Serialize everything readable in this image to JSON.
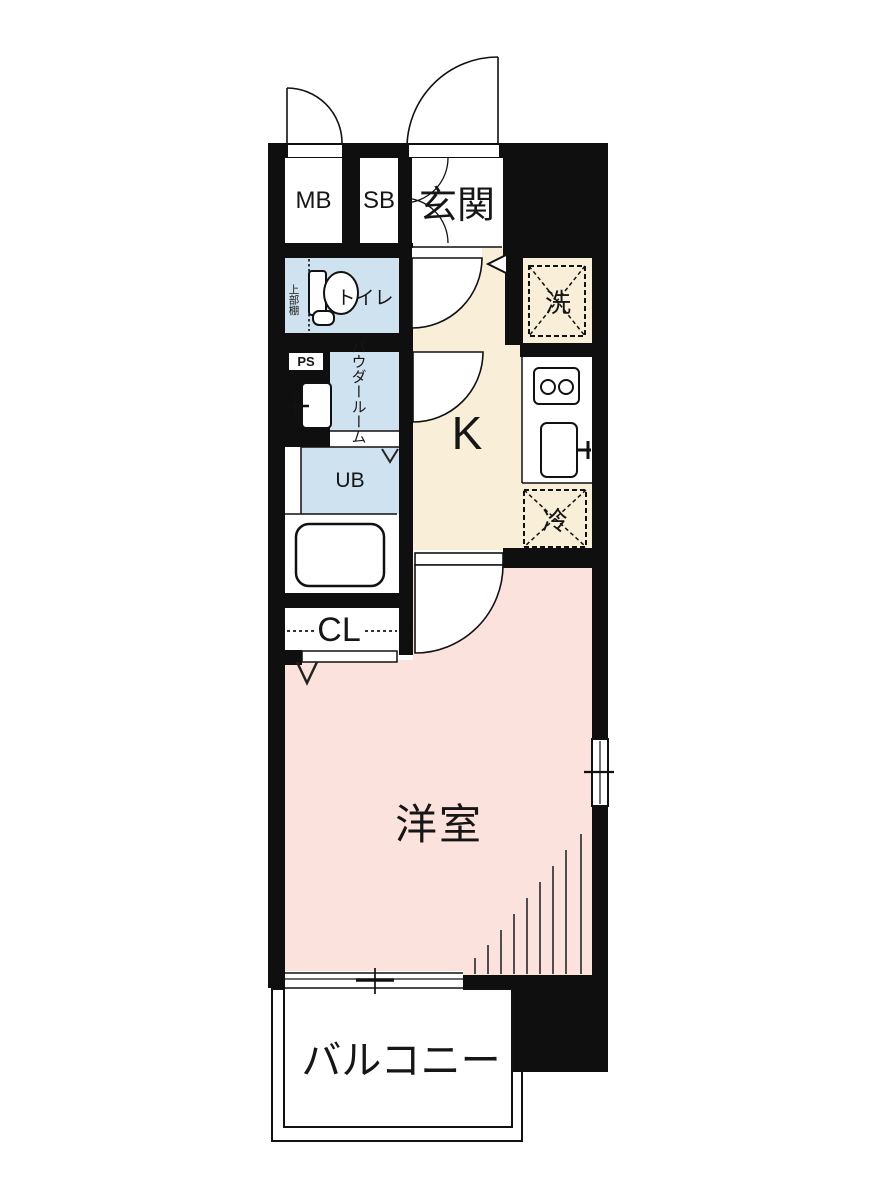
{
  "title": "apartment-floor-plan",
  "colors": {
    "wall": "#0f0f0f",
    "water_room_blue": "#cfe2f0",
    "kitchen_cream": "#f9efd8",
    "room_pink": "#fbe2dc",
    "floor_white": "#ffffff",
    "text": "#161616"
  },
  "labels": {
    "meter_box": "MB",
    "shoe_box": "SB",
    "entrance": "玄関",
    "toilet": "トイレ",
    "upper_shelf": "上部棚",
    "washer": "洗",
    "pipe_space": "PS",
    "powder_col1": "パウダー",
    "powder_col2": "ルーム",
    "kitchen": "K",
    "unit_bath": "UB",
    "refrigerator": "冷",
    "closet": "CL",
    "western_room": "洋室",
    "balcony": "バルコニー"
  }
}
